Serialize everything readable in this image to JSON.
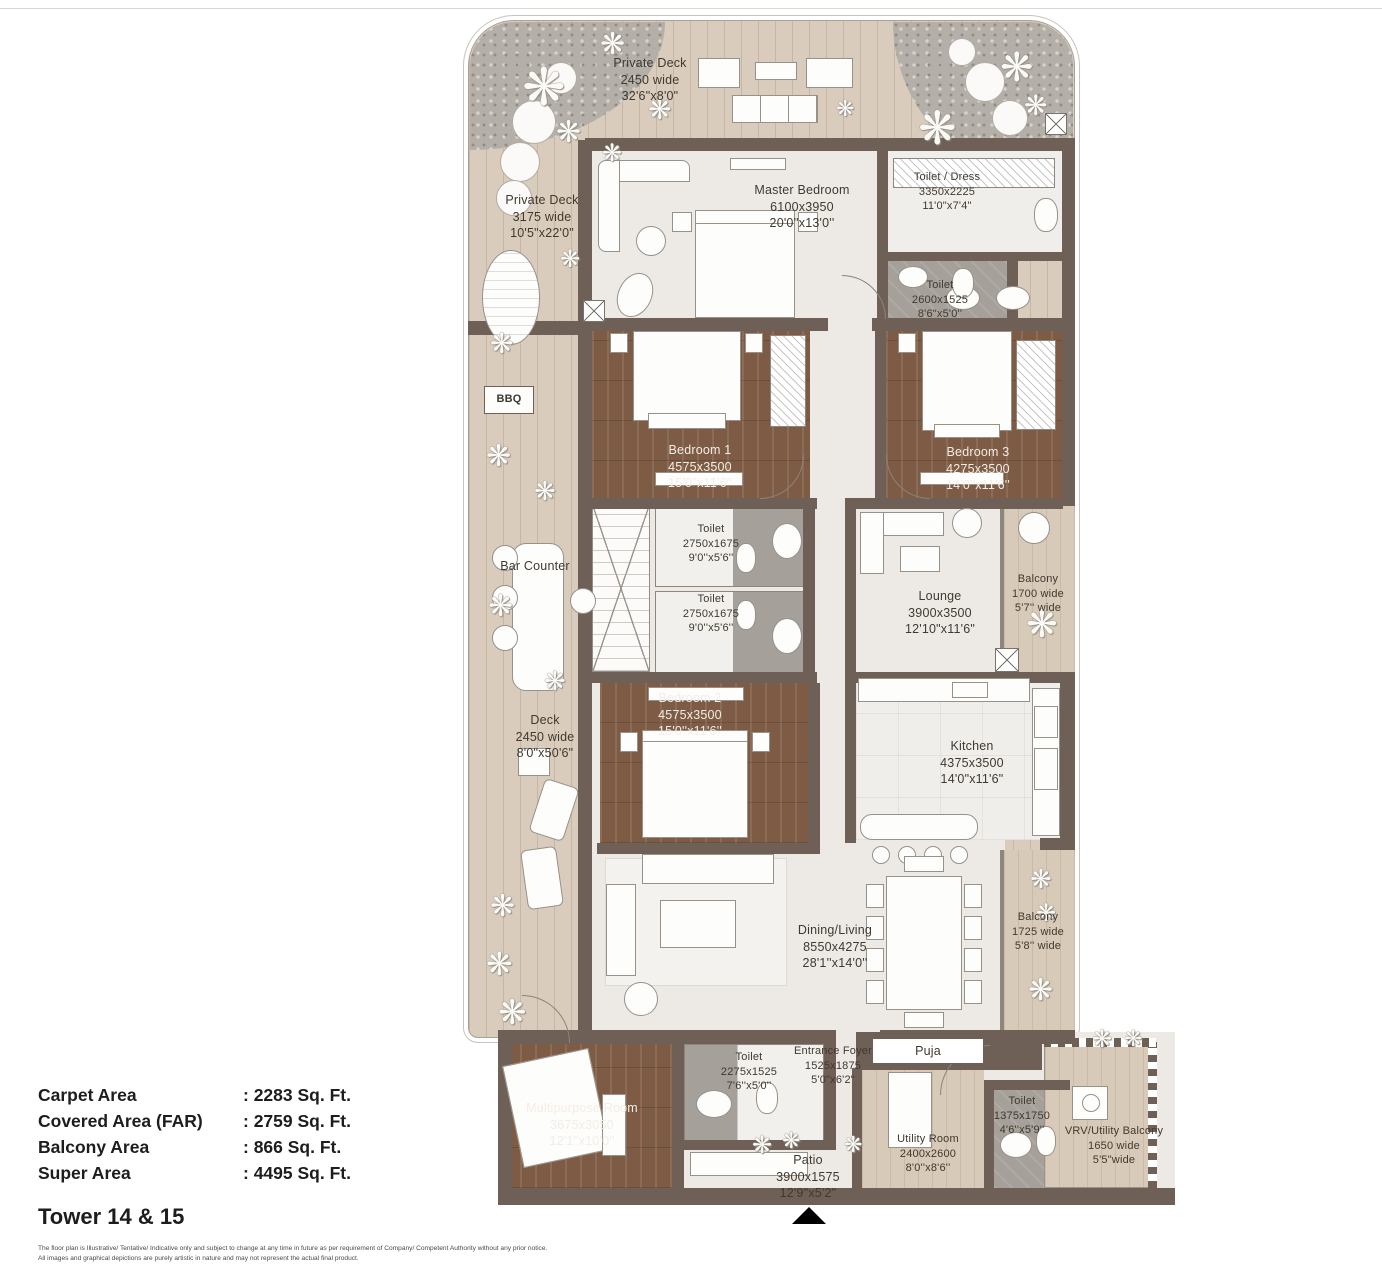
{
  "plan": {
    "rooms": {
      "private_deck_top": {
        "name": "Private Deck",
        "mm": "2450 wide",
        "ft": "32'6\"x8'0\""
      },
      "private_deck_left": {
        "name": "Private Deck",
        "mm": "3175 wide",
        "ft": "10'5\"x22'0\""
      },
      "master_bedroom": {
        "name": "Master Bedroom",
        "mm": "6100x3950",
        "ft": "20'0''x13'0''"
      },
      "toilet_dress": {
        "name": "Toilet / Dress",
        "mm": "3350x2225",
        "ft": "11'0\"x7'4\""
      },
      "toilet_master": {
        "name": "Toilet",
        "mm": "2600x1525",
        "ft": "8'6\"x5'0''"
      },
      "bedroom_1": {
        "name": "Bedroom 1",
        "mm": "4575x3500",
        "ft": "15'0''x11'6''"
      },
      "bedroom_3": {
        "name": "Bedroom 3",
        "mm": "4275x3500",
        "ft": "14'0''x11'6''"
      },
      "toilet_bed1": {
        "name": "Toilet",
        "mm": "2750x1675",
        "ft": "9'0''x5'6''"
      },
      "toilet_bed2": {
        "name": "Toilet",
        "mm": "2750x1675",
        "ft": "9'0''x5'6''"
      },
      "lounge": {
        "name": "Lounge",
        "mm": "3900x3500",
        "ft": "12'10\"x11'6\""
      },
      "balcony_upper": {
        "name": "Balcony",
        "mm": "1700 wide",
        "ft": "5'7'' wide"
      },
      "bedroom_2": {
        "name": "Bedroom 2",
        "mm": "4575x3500",
        "ft": "15'0''x11'6''"
      },
      "kitchen": {
        "name": "Kitchen",
        "mm": "4375x3500",
        "ft": "14'0\"x11'6\""
      },
      "deck_left": {
        "name": "Deck",
        "mm": "2450 wide",
        "ft": "8'0\"x50'6\""
      },
      "bar_counter": {
        "name": "Bar Counter"
      },
      "bbq": {
        "name": "BBQ"
      },
      "dining_living": {
        "name": "Dining/Living",
        "mm": "8550x4275",
        "ft": "28'1''x14'0''"
      },
      "balcony_lower": {
        "name": "Balcony",
        "mm": "1725 wide",
        "ft": "5'8'' wide"
      },
      "multipurpose_room": {
        "name": "Multipurpose Room",
        "mm": "3675x3050",
        "ft": "12'1''x10'0''"
      },
      "toilet_multipurpose": {
        "name": "Toilet",
        "mm": "2275x1525",
        "ft": "7'6''x5'0''"
      },
      "entrance_foyer": {
        "name": "Entrance Foyer",
        "mm": "1525x1875",
        "ft": "5'0\"x6'2\""
      },
      "puja": {
        "name": "Puja"
      },
      "utility_room": {
        "name": "Utility Room",
        "mm": "2400x2600",
        "ft": "8'0''x8'6''"
      },
      "toilet_utility": {
        "name": "Toilet",
        "mm": "1375x1750",
        "ft": "4'6''x5'9''"
      },
      "vrv_balcony": {
        "name": "VRV/Utility Balcony",
        "mm": "1650 wide",
        "ft": "5'5\"wide"
      },
      "patio": {
        "name": "Patio",
        "mm": "3900x1575",
        "ft": "12'9\"x5'2\""
      }
    },
    "colors": {
      "wall": "#6e6057",
      "deck_wood": "#d9ccbc",
      "bedroom_wood": "#7d5b44",
      "marble": "#edeae6",
      "toilet_tile": "#a5a099"
    }
  },
  "stats": {
    "rows": [
      {
        "label": "Carpet Area",
        "value": ": 2283 Sq. Ft."
      },
      {
        "label": "Covered Area (FAR)",
        "value": ": 2759 Sq. Ft."
      },
      {
        "label": "Balcony Area",
        "value": ": 866 Sq. Ft."
      },
      {
        "label": "Super Area",
        "value": ": 4495 Sq. Ft."
      }
    ],
    "title": "Tower 14 & 15"
  },
  "footer": {
    "line1": "The floor plan is Illustrative/ Tentative/ Indicative only and subject to change at any time in future as per requirement of Company/ Competent Authority without any prior notice.",
    "line2": "All images and graphical depictions are purely artistic in nature and may not represent the actual final product."
  }
}
